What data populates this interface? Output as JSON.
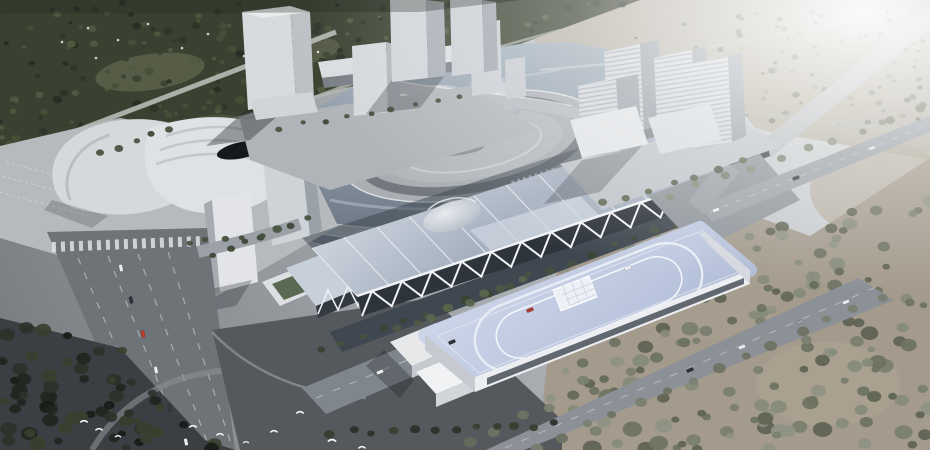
{
  "scene": {
    "type": "aerial-architectural-rendering",
    "subject": "convention-and-exhibition-center-complex-with-lake-dome-towers-forest-roads"
  },
  "palette": {
    "forest": "#3a4130",
    "forest_clearing": "#5a5f49",
    "distant_ground": "#b6b1a6",
    "right_ground": "#a49b8d",
    "water_light": "#9fabb7",
    "water_dark": "#6b7682",
    "island_plaza": "#a9aeb3",
    "ring_road": "#74797f",
    "island_inner": "#b3b7bb",
    "road_light": "#9aa0a6",
    "road_mid": "#80868d",
    "road_avenue": "#6e7378",
    "plaza_dark": "#3b3f43",
    "plaza_mid": "#55595d",
    "plaza_light": "#b7babd",
    "podium_plaza": "#b0b4b8",
    "white_bldg": "#dadde0",
    "bldg_side": "#a9aeb4",
    "bldg_top": "#e9ebed",
    "hall_facade": "#2e343c",
    "truss_white": "#f2f4f6",
    "canal": "#3f4750",
    "big_facade": "#eceef1",
    "window_band": "#4a5059",
    "green_roof": "#5a6a52",
    "car_white": "#e9ebee",
    "car_dark": "#2f343a",
    "car_red": "#c0392b",
    "bird": "#f5f6f7",
    "dash": "#d4d7da"
  },
  "decor": {
    "tree_fields": [
      {
        "name": "field-forest-top-left",
        "poly": [
          [
            0,
            0
          ],
          [
            636,
            0
          ],
          [
            520,
            44
          ],
          [
            378,
            80
          ],
          [
            296,
            100
          ],
          [
            148,
            142
          ],
          [
            0,
            186
          ]
        ],
        "count": 260,
        "rmin": 3,
        "rmax": 8,
        "colors": [
          "#2e352a",
          "#3a4233",
          "#465038",
          "#272e24",
          "#515a41"
        ]
      },
      {
        "name": "field-trees-top-right",
        "poly": [
          [
            560,
            52
          ],
          [
            700,
            16
          ],
          [
            930,
            2
          ],
          [
            930,
            136
          ],
          [
            762,
            128
          ],
          [
            640,
            92
          ]
        ],
        "count": 95,
        "rmin": 2.5,
        "rmax": 6,
        "colors": [
          "#7e8374",
          "#8a8f7f",
          "#737866",
          "#969a8b"
        ]
      },
      {
        "name": "field-trees-right",
        "poly": [
          [
            566,
            238
          ],
          [
            700,
            196
          ],
          [
            800,
            232
          ],
          [
            930,
            160
          ],
          [
            930,
            450
          ],
          [
            560,
            450
          ],
          [
            540,
            430
          ]
        ],
        "count": 185,
        "rmin": 4,
        "rmax": 10,
        "colors": [
          "#6d7261",
          "#7a7f6e",
          "#868b7a",
          "#5e6353",
          "#8f9383"
        ]
      },
      {
        "name": "field-trees-bottom-left",
        "poly": [
          [
            0,
            318
          ],
          [
            120,
            348
          ],
          [
            205,
            440
          ],
          [
            235,
            450
          ],
          [
            0,
            450
          ]
        ],
        "count": 65,
        "rmin": 4,
        "rmax": 9,
        "colors": [
          "#1f2620",
          "#2b3228",
          "#37402e",
          "#171c17"
        ]
      }
    ],
    "tree_rows": [
      {
        "name": "row-canal",
        "p1": [
          320,
          352
        ],
        "p2": [
          738,
          200
        ],
        "n": 21,
        "r": 4.2,
        "colors": [
          "#3a4434",
          "#475241"
        ],
        "jitter": 3
      },
      {
        "name": "row-frontroad",
        "p1": [
          398,
          330
        ],
        "p2": [
          520,
          281
        ],
        "n": 8,
        "r": 4.6,
        "colors": [
          "#4e5844",
          "#5a654d"
        ],
        "jitter": 3
      },
      {
        "name": "row-blvd-a",
        "p1": [
          470,
          442
        ],
        "p2": [
          840,
          272
        ],
        "n": 15,
        "r": 5.5,
        "colors": [
          "#6e7363",
          "#7b8070",
          "#656a59"
        ],
        "jitter": 3
      },
      {
        "name": "row-blvd-b",
        "p1": [
          534,
          450
        ],
        "p2": [
          880,
          296
        ],
        "n": 14,
        "r": 5.5,
        "colors": [
          "#6e7363",
          "#7b8070"
        ],
        "jitter": 3
      },
      {
        "name": "row-ra",
        "p1": [
          668,
          196
        ],
        "p2": [
          918,
          110
        ],
        "n": 10,
        "r": 4.5,
        "colors": [
          "#767c6a",
          "#838976"
        ],
        "jitter": 3
      },
      {
        "name": "row-bottom",
        "p1": [
          332,
          432
        ],
        "p2": [
          556,
          424
        ],
        "n": 12,
        "r": 4.5,
        "colors": [
          "#2c332a",
          "#384030"
        ],
        "jitter": 3
      },
      {
        "name": "row-mall-a",
        "p1": [
          100,
          152
        ],
        "p2": [
          170,
          130
        ],
        "n": 5,
        "r": 3.8,
        "colors": [
          "#3e4836",
          "#4a5440"
        ],
        "jitter": 2
      },
      {
        "name": "row-mall-b",
        "p1": [
          214,
          254
        ],
        "p2": [
          308,
          218
        ],
        "n": 7,
        "r": 4,
        "colors": [
          "#3e4836",
          "#4a5440"
        ],
        "jitter": 2
      },
      {
        "name": "row-island",
        "p1": [
          188,
          242
        ],
        "p2": [
          262,
          234
        ],
        "n": 5,
        "r": 3.6,
        "colors": [
          "#46503c"
        ],
        "jitter": 2
      },
      {
        "name": "row-towers-plaza",
        "p1": [
          604,
          204
        ],
        "p2": [
          742,
          162
        ],
        "n": 7,
        "r": 4,
        "colors": [
          "#525c48",
          "#5d6751"
        ],
        "jitter": 2
      },
      {
        "name": "row-podium",
        "p1": [
          280,
          128
        ],
        "p2": [
          460,
          96
        ],
        "n": 9,
        "r": 3.2,
        "colors": [
          "#4a5440",
          "#3e4836"
        ],
        "jitter": 2
      }
    ],
    "cars": [
      {
        "x": 121,
        "y": 268,
        "a": 78,
        "c": "#e9ebee"
      },
      {
        "x": 131,
        "y": 300,
        "a": 78,
        "c": "#2f343a"
      },
      {
        "x": 143,
        "y": 334,
        "a": 78,
        "c": "#c0392b"
      },
      {
        "x": 156,
        "y": 370,
        "a": 78,
        "c": "#e9ebee"
      },
      {
        "x": 170,
        "y": 408,
        "a": 78,
        "c": "#33383d"
      },
      {
        "x": 186,
        "y": 442,
        "a": 78,
        "c": "#e9ebee"
      },
      {
        "x": 380,
        "y": 372,
        "a": -23,
        "c": "#e9ebee"
      },
      {
        "x": 452,
        "y": 342,
        "a": -23,
        "c": "#2f343a"
      },
      {
        "x": 530,
        "y": 310,
        "a": -23,
        "c": "#b03a30"
      },
      {
        "x": 628,
        "y": 268,
        "a": -23,
        "c": "#eceef0"
      },
      {
        "x": 716,
        "y": 210,
        "a": -19,
        "c": "#e9ebee"
      },
      {
        "x": 796,
        "y": 178,
        "a": -19,
        "c": "#30353a"
      },
      {
        "x": 872,
        "y": 148,
        "a": -19,
        "c": "#dcdfe2"
      },
      {
        "x": 690,
        "y": 370,
        "a": -23,
        "c": "#2f343a"
      },
      {
        "x": 742,
        "y": 347,
        "a": -23,
        "c": "#e9ebee"
      },
      {
        "x": 800,
        "y": 322,
        "a": -23,
        "c": "#9aa0a6"
      },
      {
        "x": 846,
        "y": 302,
        "a": -23,
        "c": "#e9ebee"
      }
    ],
    "birds": [
      [
        84,
        421
      ],
      [
        99,
        429
      ],
      [
        118,
        436
      ],
      [
        193,
        426
      ],
      [
        220,
        434
      ],
      [
        246,
        442
      ],
      [
        274,
        431
      ],
      [
        300,
        412
      ],
      [
        332,
        440
      ],
      [
        362,
        447
      ]
    ],
    "forest_specks": [
      [
        88,
        28
      ],
      [
        118,
        40
      ],
      [
        148,
        24
      ],
      [
        182,
        48
      ],
      [
        208,
        34
      ],
      [
        244,
        56
      ],
      [
        96,
        58
      ],
      [
        62,
        42
      ],
      [
        282,
        30
      ],
      [
        318,
        52
      ]
    ],
    "hall": {
      "back": [
        [
          312,
          248
        ],
        [
          700,
          122
        ]
      ],
      "front": [
        [
          357,
          296
        ],
        [
          745,
          168
        ]
      ],
      "facade_bottom": [
        [
          362,
          316
        ],
        [
          750,
          188
        ]
      ],
      "ribs": 12,
      "truss_teeth": 13
    }
  }
}
